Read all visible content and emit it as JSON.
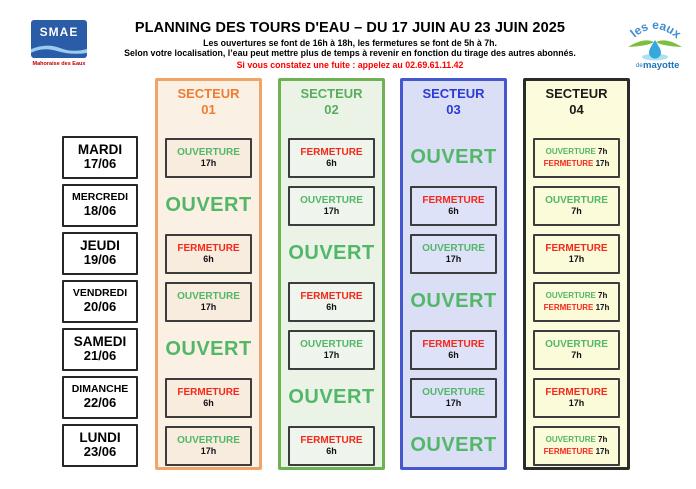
{
  "logo_smae": {
    "name": "SMAE",
    "tagline": "Mahoraise des Eaux"
  },
  "logo_eaux": {
    "arc_text": "les eaux",
    "small_text": "de",
    "main_text": "mayotte"
  },
  "header": {
    "title": "PLANNING DES TOURS D'EAU – DU 17 JUIN AU 23 JUIN 2025",
    "subtitle_1": "Les ouvertures se font de 16h à 18h, les fermetures se font de 5h à 7h.",
    "subtitle_2": "Selon votre localisation, l’eau peut mettre plus de temps à revenir en fonction du tirage des autres abonnés.",
    "alert": "Si vous constatez une fuite : appelez au 02.69.61.11.42"
  },
  "colors": {
    "open_green": "#53B768",
    "close_red": "#F3291B",
    "alert_red": "#FF0000",
    "hour_black": "#111111"
  },
  "schedule": {
    "days": [
      {
        "name": "MARDI",
        "date": "17/06"
      },
      {
        "name": "MERCREDI",
        "date": "18/06"
      },
      {
        "name": "JEUDI",
        "date": "19/06"
      },
      {
        "name": "VENDREDI",
        "date": "20/06"
      },
      {
        "name": "SAMEDI",
        "date": "21/06"
      },
      {
        "name": "DIMANCHE",
        "date": "22/06"
      },
      {
        "name": "LUNDI",
        "date": "23/06"
      }
    ],
    "sectors": [
      {
        "label": "SECTEUR",
        "number": "01",
        "text_color": "#ED7D31",
        "border_color": "#F1A468",
        "bg": "#FBF0E4",
        "cell_bg": "#F7ECDD"
      },
      {
        "label": "SECTEUR",
        "number": "02",
        "text_color": "#58AE5C",
        "border_color": "#6FB254",
        "bg": "#EAF3E6",
        "cell_bg": "#EFF5EC"
      },
      {
        "label": "SECTEUR",
        "number": "03",
        "text_color": "#2B3BD6",
        "border_color": "#4457CE",
        "bg": "#DADFF6",
        "cell_bg": "#DDE2F8"
      },
      {
        "label": "SECTEUR",
        "number": "04",
        "text_color": "#1A1A1A",
        "border_color": "#2B2B2B",
        "bg": "#FCFCDD",
        "cell_bg": "#FBFBDA"
      }
    ],
    "open_label": "OUVERT",
    "cells": [
      [
        {
          "type": "single",
          "action": "OUVERTURE",
          "hour": "17h"
        },
        {
          "type": "single",
          "action": "FERMETURE",
          "hour": "6h"
        },
        {
          "type": "open"
        },
        {
          "type": "double",
          "lines": [
            [
              "OUVERTURE",
              "7h"
            ],
            [
              "FERMETURE",
              "17h"
            ]
          ]
        }
      ],
      [
        {
          "type": "open"
        },
        {
          "type": "single",
          "action": "OUVERTURE",
          "hour": "17h"
        },
        {
          "type": "single",
          "action": "FERMETURE",
          "hour": "6h"
        },
        {
          "type": "single",
          "action": "OUVERTURE",
          "hour": "7h"
        }
      ],
      [
        {
          "type": "single",
          "action": "FERMETURE",
          "hour": "6h"
        },
        {
          "type": "open"
        },
        {
          "type": "single",
          "action": "OUVERTURE",
          "hour": "17h"
        },
        {
          "type": "single",
          "action": "FERMETURE",
          "hour": "17h"
        }
      ],
      [
        {
          "type": "single",
          "action": "OUVERTURE",
          "hour": "17h"
        },
        {
          "type": "single",
          "action": "FERMETURE",
          "hour": "6h"
        },
        {
          "type": "open"
        },
        {
          "type": "double",
          "lines": [
            [
              "OUVERTURE",
              "7h"
            ],
            [
              "FERMETURE",
              "17h"
            ]
          ]
        }
      ],
      [
        {
          "type": "open"
        },
        {
          "type": "single",
          "action": "OUVERTURE",
          "hour": "17h"
        },
        {
          "type": "single",
          "action": "FERMETURE",
          "hour": "6h"
        },
        {
          "type": "single",
          "action": "OUVERTURE",
          "hour": "7h"
        }
      ],
      [
        {
          "type": "single",
          "action": "FERMETURE",
          "hour": "6h"
        },
        {
          "type": "open"
        },
        {
          "type": "single",
          "action": "OUVERTURE",
          "hour": "17h"
        },
        {
          "type": "single",
          "action": "FERMETURE",
          "hour": "17h"
        }
      ],
      [
        {
          "type": "single",
          "action": "OUVERTURE",
          "hour": "17h"
        },
        {
          "type": "single",
          "action": "FERMETURE",
          "hour": "6h"
        },
        {
          "type": "open"
        },
        {
          "type": "double",
          "lines": [
            [
              "OUVERTURE",
              "7h"
            ],
            [
              "FERMETURE",
              "17h"
            ]
          ]
        }
      ]
    ]
  }
}
